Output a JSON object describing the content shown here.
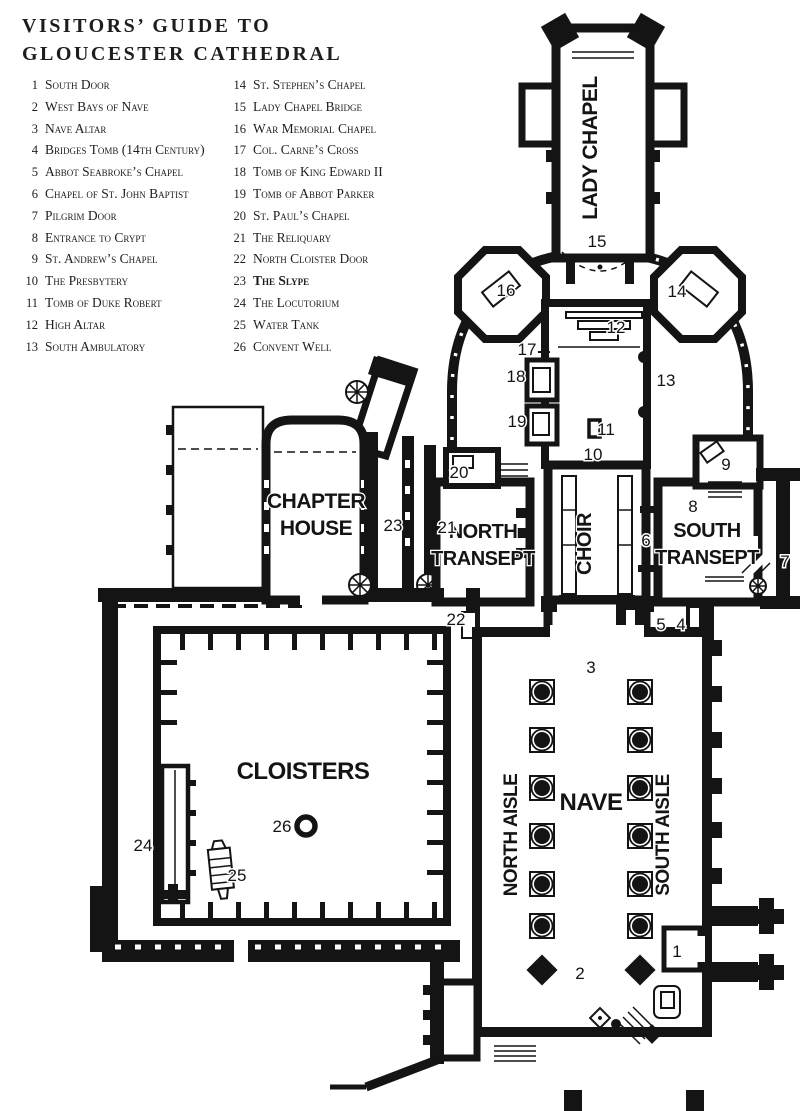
{
  "title": {
    "line1": "VISITORS’ GUIDE TO",
    "line2": "GLOUCESTER CATHEDRAL"
  },
  "legend": {
    "columns": [
      {
        "items": [
          {
            "n": "1",
            "label": "South Door"
          },
          {
            "n": "2",
            "label": "West Bays of Nave"
          },
          {
            "n": "3",
            "label": "Nave Altar"
          },
          {
            "n": "4",
            "label": "Bridges Tomb (14th Century)"
          },
          {
            "n": "5",
            "label": "Abbot Seabroke’s Chapel"
          },
          {
            "n": "6",
            "label": "Chapel of St. John Baptist"
          },
          {
            "n": "7",
            "label": "Pilgrim Door"
          },
          {
            "n": "8",
            "label": "Entrance to Crypt"
          },
          {
            "n": "9",
            "label": "St. Andrew’s Chapel"
          },
          {
            "n": "10",
            "label": "The Presbytery"
          },
          {
            "n": "11",
            "label": "Tomb of Duke Robert"
          },
          {
            "n": "12",
            "label": "High Altar"
          },
          {
            "n": "13",
            "label": "South Ambulatory"
          }
        ]
      },
      {
        "items": [
          {
            "n": "14",
            "label": "St. Stephen’s Chapel"
          },
          {
            "n": "15",
            "label": "Lady Chapel Bridge"
          },
          {
            "n": "16",
            "label": "War Memorial Chapel"
          },
          {
            "n": "17",
            "label": "Col. Carne’s Cross"
          },
          {
            "n": "18",
            "label": "Tomb of King Edward II"
          },
          {
            "n": "19",
            "label": "Tomb of Abbot Parker"
          },
          {
            "n": "20",
            "label": "St. Paul’s Chapel"
          },
          {
            "n": "21",
            "label": "The Reliquary"
          },
          {
            "n": "22",
            "label": "North Cloister Door"
          },
          {
            "n": "23",
            "label": "The Slype",
            "bold": true
          },
          {
            "n": "24",
            "label": "The Locutorium"
          },
          {
            "n": "25",
            "label": "Water Tank"
          },
          {
            "n": "26",
            "label": "Convent Well"
          }
        ]
      }
    ]
  },
  "plan": {
    "ink": "#141414",
    "room_labels": [
      {
        "id": "lady-chapel",
        "lines": [
          "LADY CHAPEL"
        ],
        "x": 597,
        "y": 148,
        "size": 21,
        "rotate": -90
      },
      {
        "id": "chapter-house",
        "lines": [
          "CHAPTER",
          "HOUSE"
        ],
        "x": 316,
        "y": 508,
        "size": 21,
        "lh": 27
      },
      {
        "id": "north-transept",
        "lines": [
          "NORTH",
          "TRANSEPT"
        ],
        "x": 483,
        "y": 538,
        "size": 20,
        "lh": 27
      },
      {
        "id": "choir",
        "lines": [
          "CHOIR"
        ],
        "x": 591,
        "y": 544,
        "size": 20,
        "rotate": -90
      },
      {
        "id": "south-transept",
        "lines": [
          "SOUTH",
          "TRANSEPT"
        ],
        "x": 707,
        "y": 537,
        "size": 20,
        "lh": 27
      },
      {
        "id": "cloisters",
        "lines": [
          "CLOISTERS"
        ],
        "x": 303,
        "y": 779,
        "size": 24
      },
      {
        "id": "north-aisle",
        "lines": [
          "NORTH AISLE"
        ],
        "x": 517,
        "y": 835,
        "size": 19,
        "rotate": -90
      },
      {
        "id": "nave",
        "lines": [
          "NAVE"
        ],
        "x": 591,
        "y": 810,
        "size": 24
      },
      {
        "id": "south-aisle",
        "lines": [
          "SOUTH AISLE"
        ],
        "x": 669,
        "y": 835,
        "size": 19,
        "rotate": -90
      }
    ],
    "markers": [
      {
        "n": "1",
        "x": 677,
        "y": 957
      },
      {
        "n": "2",
        "x": 580,
        "y": 979
      },
      {
        "n": "3",
        "x": 591,
        "y": 673
      },
      {
        "n": "4",
        "x": 681,
        "y": 630
      },
      {
        "n": "5",
        "x": 661,
        "y": 630
      },
      {
        "n": "6",
        "x": 646,
        "y": 546
      },
      {
        "n": "7",
        "x": 785,
        "y": 567
      },
      {
        "n": "8",
        "x": 693,
        "y": 512
      },
      {
        "n": "9",
        "x": 726,
        "y": 470
      },
      {
        "n": "10",
        "x": 593,
        "y": 460
      },
      {
        "n": "11",
        "x": 606,
        "y": 435
      },
      {
        "n": "12",
        "x": 616,
        "y": 333
      },
      {
        "n": "13",
        "x": 666,
        "y": 386
      },
      {
        "n": "14",
        "x": 677,
        "y": 297
      },
      {
        "n": "15",
        "x": 597,
        "y": 247
      },
      {
        "n": "16",
        "x": 506,
        "y": 296
      },
      {
        "n": "17",
        "x": 527,
        "y": 355
      },
      {
        "n": "18",
        "x": 516,
        "y": 382
      },
      {
        "n": "19",
        "x": 517,
        "y": 427
      },
      {
        "n": "20",
        "x": 459,
        "y": 478
      },
      {
        "n": "21",
        "x": 447,
        "y": 533
      },
      {
        "n": "22",
        "x": 456,
        "y": 625
      },
      {
        "n": "23",
        "x": 393,
        "y": 531
      },
      {
        "n": "24",
        "x": 143,
        "y": 851
      },
      {
        "n": "25",
        "x": 237,
        "y": 881
      },
      {
        "n": "26",
        "x": 282,
        "y": 832
      }
    ]
  }
}
